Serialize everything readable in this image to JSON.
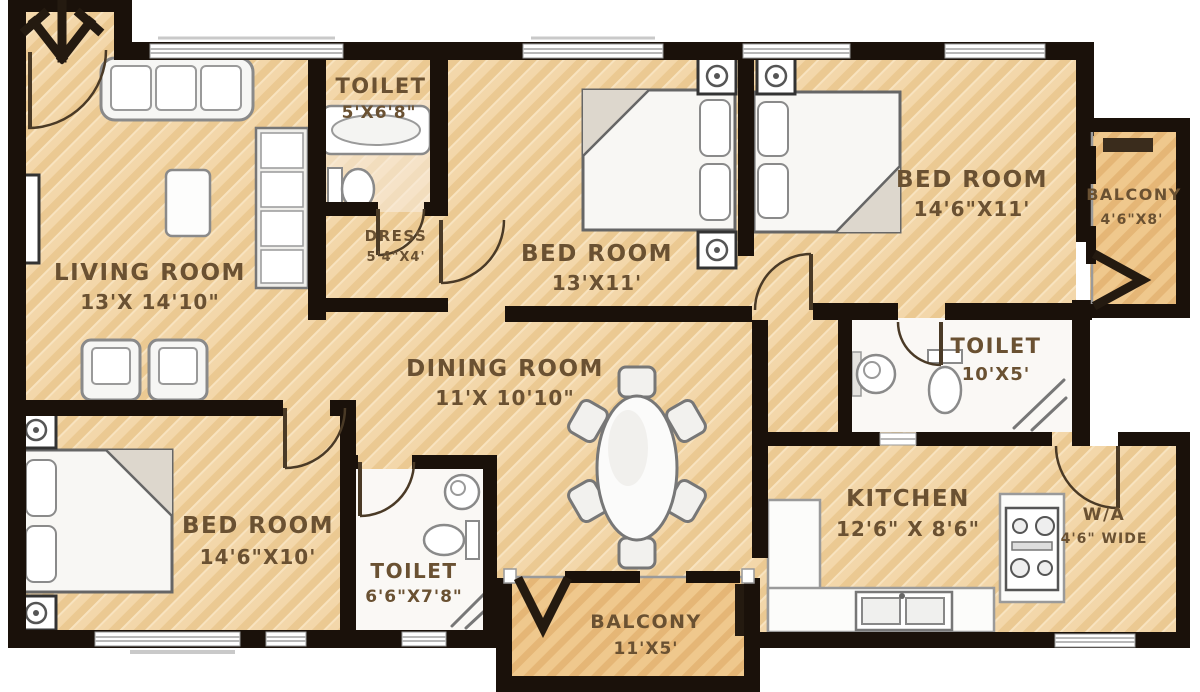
{
  "plan_title": "apartment-floor-plan",
  "colors": {
    "wall": "#1a110a",
    "floor": "#f3d7aa",
    "floor_stripe": "#ebc992",
    "balcony_floor": "#efc88d",
    "balcony_stripe": "#e5b676",
    "tile_floor": "#faf8f5",
    "label_text": "#6a5132",
    "fixture_stroke": "#8a8a8a",
    "window": "#b8b8b8"
  },
  "rooms": [
    {
      "id": "living-room",
      "name": "LIVING ROOM",
      "dims": "13'X 14'10\""
    },
    {
      "id": "toilet-top",
      "name": "TOILET",
      "dims": "5'X6'8\""
    },
    {
      "id": "dress",
      "name": "DRESS",
      "dims": "5'4\"X4'"
    },
    {
      "id": "bedroom-center",
      "name": "BED ROOM",
      "dims": "13'X11'"
    },
    {
      "id": "bedroom-right",
      "name": "BED ROOM",
      "dims": "14'6\"X11'"
    },
    {
      "id": "balcony-right",
      "name": "BALCONY",
      "dims": "4'6\"X8'"
    },
    {
      "id": "toilet-right",
      "name": "TOILET",
      "dims": "10'X5'"
    },
    {
      "id": "dining-room",
      "name": "DINING ROOM",
      "dims": "11'X 10'10\""
    },
    {
      "id": "bedroom-left",
      "name": "BED ROOM",
      "dims": "14'6\"X10'"
    },
    {
      "id": "toilet-bottom",
      "name": "TOILET",
      "dims": "6'6\"X7'8\""
    },
    {
      "id": "balcony-bottom",
      "name": "BALCONY",
      "dims": "11'X5'"
    },
    {
      "id": "kitchen",
      "name": "KITCHEN",
      "dims": "12'6\" X 8'6\""
    },
    {
      "id": "wash-area",
      "name": "W/A",
      "dims": "4'6\" WIDE"
    }
  ]
}
